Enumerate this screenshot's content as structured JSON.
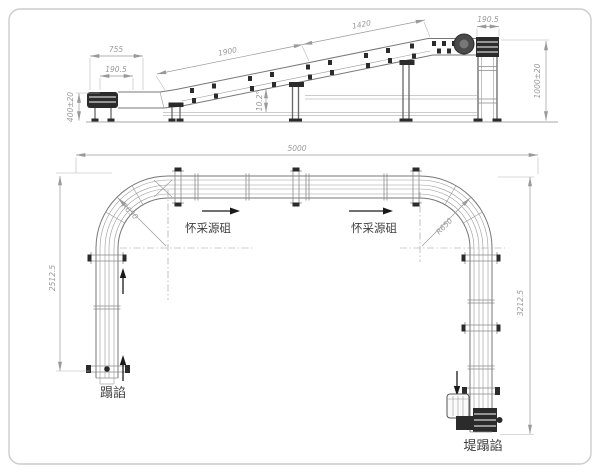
{
  "elevation": {
    "dims": {
      "infeed_unit_width": "755",
      "infeed_belt_width": "190.5",
      "infeed_height": "400±20",
      "incline_length": "1900",
      "head_section_length": "1420",
      "incline_angle": "10.2°",
      "head_belt_width": "190.5",
      "discharge_height": "1000±20"
    }
  },
  "plan": {
    "dims": {
      "overall_length": "5000",
      "left_run_length": "2512.5",
      "right_run_length": "3212.5",
      "left_curve_radius": "R650",
      "right_curve_radius": "R650"
    },
    "labels": {
      "flow_left": "怀采源砠",
      "flow_right": "怀采源砠",
      "infeed": "蹋諂",
      "outfeed": "堤蹋諂"
    }
  },
  "colors": {
    "line": "#8a8a8a",
    "equipment_dark": "#2b2b2b",
    "dim_text": "#9a9a9a",
    "label_text": "#3f3f3f",
    "border": "#cccccc",
    "background": "#ffffff"
  }
}
